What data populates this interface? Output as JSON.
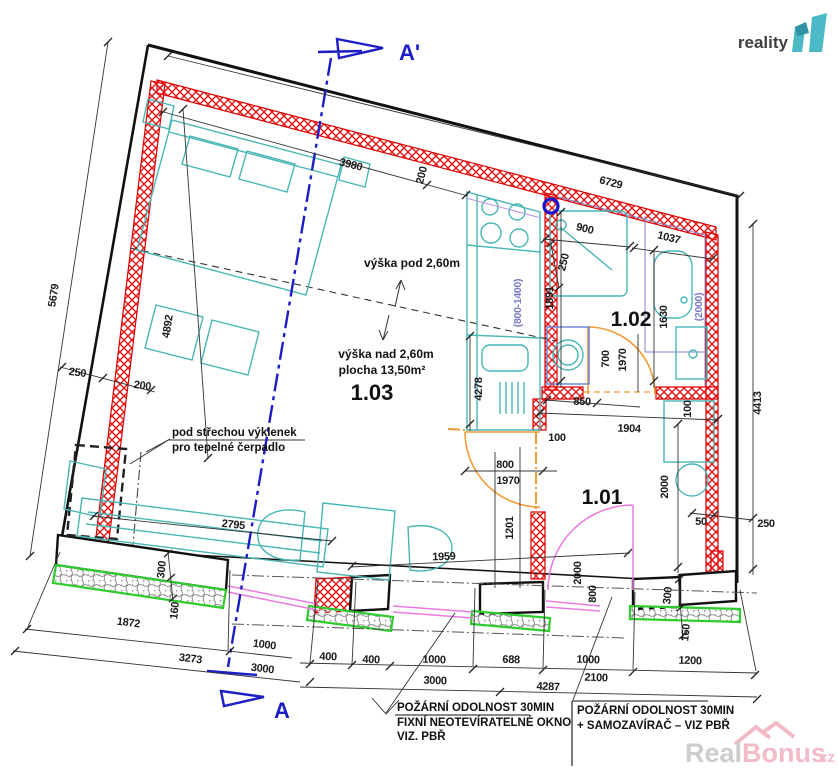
{
  "branding": {
    "logo_text": "reality",
    "logo_number": "11",
    "watermark_real": "Real",
    "watermark_bonus": "Bonus",
    "watermark_cz": ".cz"
  },
  "section_markers": {
    "top": "A'",
    "bottom": "A"
  },
  "rooms": {
    "living": "1.03",
    "bathroom": "1.02",
    "hall": "1.01"
  },
  "annotations": {
    "height_under": "výška pod 2,60m",
    "height_over": "výška nad 2,60m",
    "area": "plocha 13,50m²",
    "niche_line1": "pod střechou výklenek",
    "niche_line2": "pro tepelné čerpadlo"
  },
  "notes": {
    "fire_left_1": "POŽÁRNÍ ODOLNOST 30MIN",
    "fire_left_2": "FIXNÍ NEOTEVÍRATELNÉ OKNO",
    "fire_left_3": "VIZ. PBŘ",
    "fire_right_1": "POŽÁRNÍ ODOLNOST 30MIN",
    "fire_right_2": "+ SAMOZAVÍRAČ – VIZ PBŘ"
  },
  "dims": {
    "top_width": "6729",
    "top_wall": "250",
    "top_inner": "3980",
    "top_wall2": "200",
    "left_height": "5679",
    "left_wall": "250",
    "left_wall2": "200",
    "bed_wall": "4892",
    "shower_width": "900",
    "toilet_width": "1037",
    "shower_depth": "1891",
    "toilet_depth": "1630",
    "bath_parapet": "(2000)",
    "kitchen_parapet": "(800-1400)",
    "kitchen_length": "4278",
    "bath_door_w": "700",
    "bath_door_h": "1970",
    "hall_a": "850",
    "hall_b": "1904",
    "hall_gap1": "100",
    "hall_gap2": "100",
    "main_door_w": "800",
    "main_door_h": "1970",
    "door_pier": "1201",
    "right_height": "4413",
    "hall_depth": "2000",
    "right_gap": "50",
    "right_wall": "250",
    "sofa_length": "2795",
    "table_length": "1959",
    "plinth_left": "300",
    "paving_left": "160",
    "seg_1872": "1872",
    "seg_1000a": "1000",
    "seg_3273": "3273",
    "seg_3000a": "3000",
    "pier_400a": "400",
    "pier_400b": "400",
    "win_1000b": "1000",
    "pier_688": "688",
    "win_1000c": "1000",
    "win_1200": "1200",
    "seg_3000b": "3000",
    "seg_4287": "4287",
    "seg_2100": "2100",
    "plinth_right": "300",
    "paving_right": "160",
    "balc_door_h": "2000",
    "balc_door_w": "800"
  },
  "colors": {
    "wall_hatch_red": "#e31414",
    "outline_black": "#111111",
    "furniture_cyan": "#49b6b6",
    "door_orange": "#f09a32",
    "window_pink": "#ea7ae2",
    "paving_green": "#2ecc2e",
    "section_blue": "#1d1dc8",
    "parapet_note_blue": "#7a7ac8",
    "logo_teal": "#4cb9c6",
    "watermark_pink": "#e8849a"
  }
}
